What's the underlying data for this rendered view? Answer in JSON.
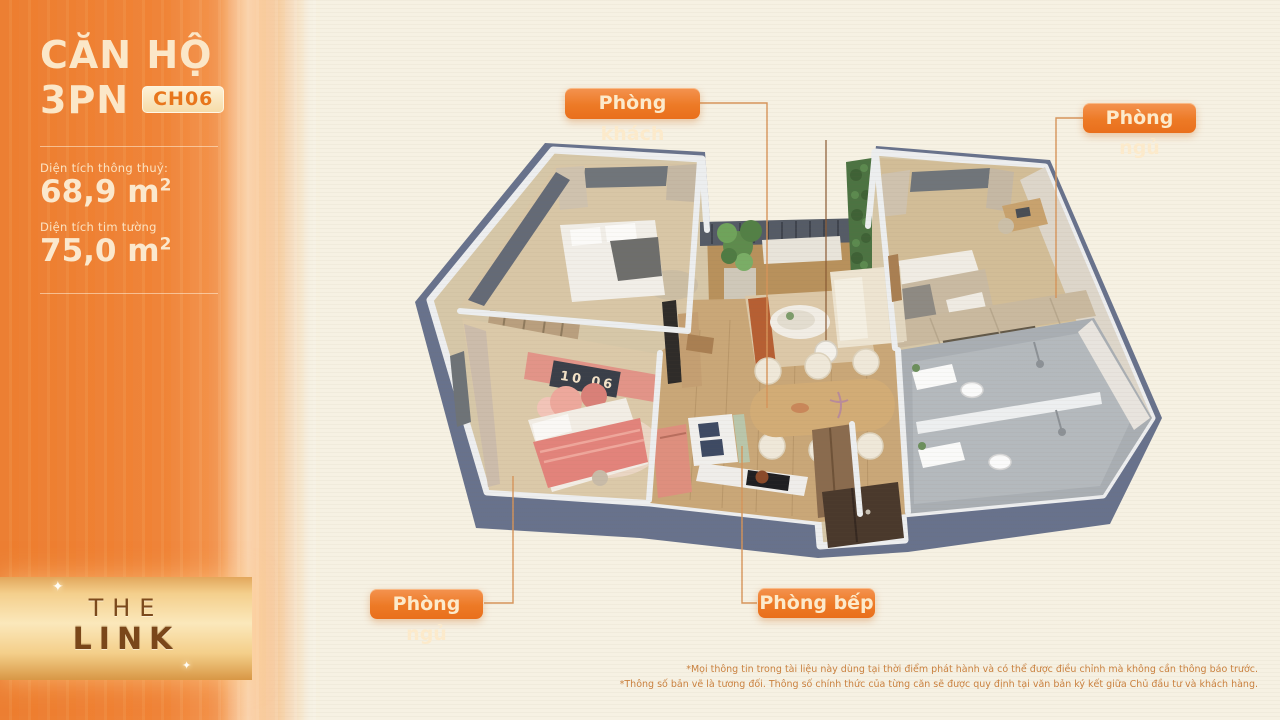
{
  "sidebar": {
    "title": "CĂN HỘ",
    "subtitle": "3PN",
    "unit_code": "CH06",
    "areas": [
      {
        "label": "Diện tích thông thuỷ:",
        "value": "68,9 m",
        "sup": "2"
      },
      {
        "label": "Diện tích tim tường",
        "value": "75,0 m",
        "sup": "2"
      }
    ],
    "logo": {
      "line1": "THE",
      "line2": "LINK"
    }
  },
  "callouts": [
    {
      "id": "living-room",
      "label": "Phòng khách"
    },
    {
      "id": "bedroom-top",
      "label": "Phòng ngủ"
    },
    {
      "id": "bedroom-bottom",
      "label": "Phòng ngủ"
    },
    {
      "id": "kitchen",
      "label": "Phòng bếp"
    }
  ],
  "plan": {
    "wall_sign": "10 06"
  },
  "footnotes": [
    "*Mọi thông tin trong tài liệu này dùng tại thời điểm phát hành và có thể được điều chỉnh mà không cần thông báo trước.",
    "*Thông số bản vẽ là tương đối. Thông số chính thức của từng căn sẽ được quy định tại văn bản ký kết giữa Chủ đầu tư và khách hàng."
  ],
  "colors": {
    "accent_orange": "#ED7A26",
    "badge_text": "#FCEACB",
    "sidebar_orange": "#EF8439",
    "callout_line": "#D6945A",
    "wall_side": "#68728C",
    "background_cream": "#F6F1E3"
  }
}
